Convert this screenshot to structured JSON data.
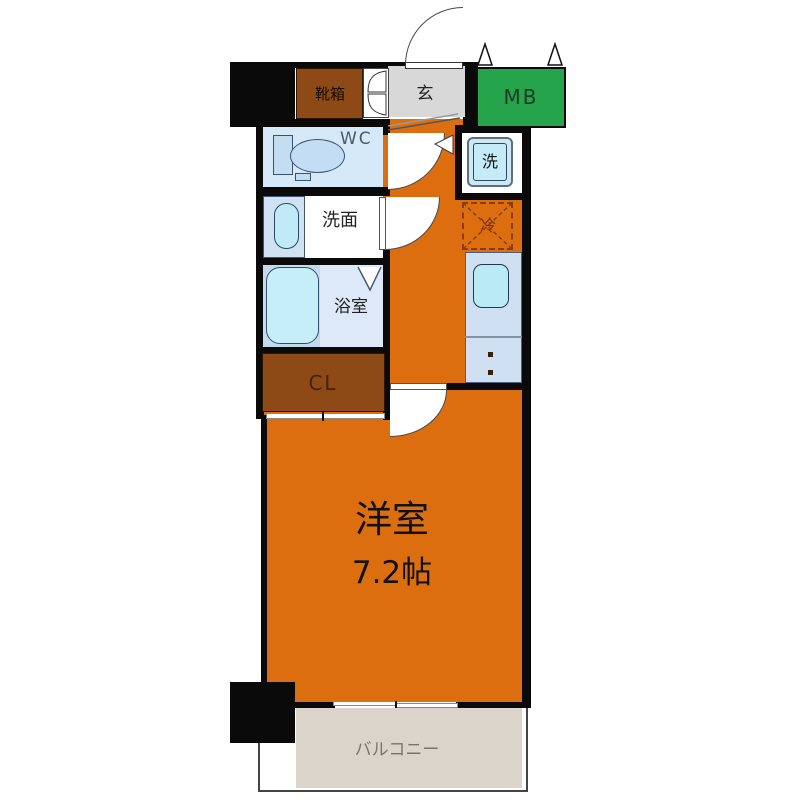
{
  "plan": {
    "title": "apartment-floor-plan",
    "rooms": {
      "shoe_box": {
        "label": "靴箱"
      },
      "entrance": {
        "label": "玄"
      },
      "meter_box": {
        "label": "MB"
      },
      "wc": {
        "label": "WC"
      },
      "washer": {
        "label": "洗"
      },
      "washroom": {
        "label": "洗面"
      },
      "fridge": {
        "label": "冷"
      },
      "bathroom": {
        "label": "浴室"
      },
      "closet": {
        "label": "CL"
      },
      "main_room": {
        "label": "洋室",
        "size": "7.2帖"
      },
      "balcony": {
        "label": "バルコニー"
      }
    },
    "colors": {
      "wall": "#0a0a0a",
      "floor_orange": "#dd6e10",
      "storage_brown": "#8d4a16",
      "meter_box_green": "#25a44c",
      "entrance_gray": "#d8d8d8",
      "wet_room_blue": "#d6e9f8",
      "fixture_cyan": "#c6eef8",
      "kitchen_blue": "#cfe0f3",
      "balcony_beige": "#dbd4cb",
      "fridge_dash": "#8a3c10"
    }
  }
}
